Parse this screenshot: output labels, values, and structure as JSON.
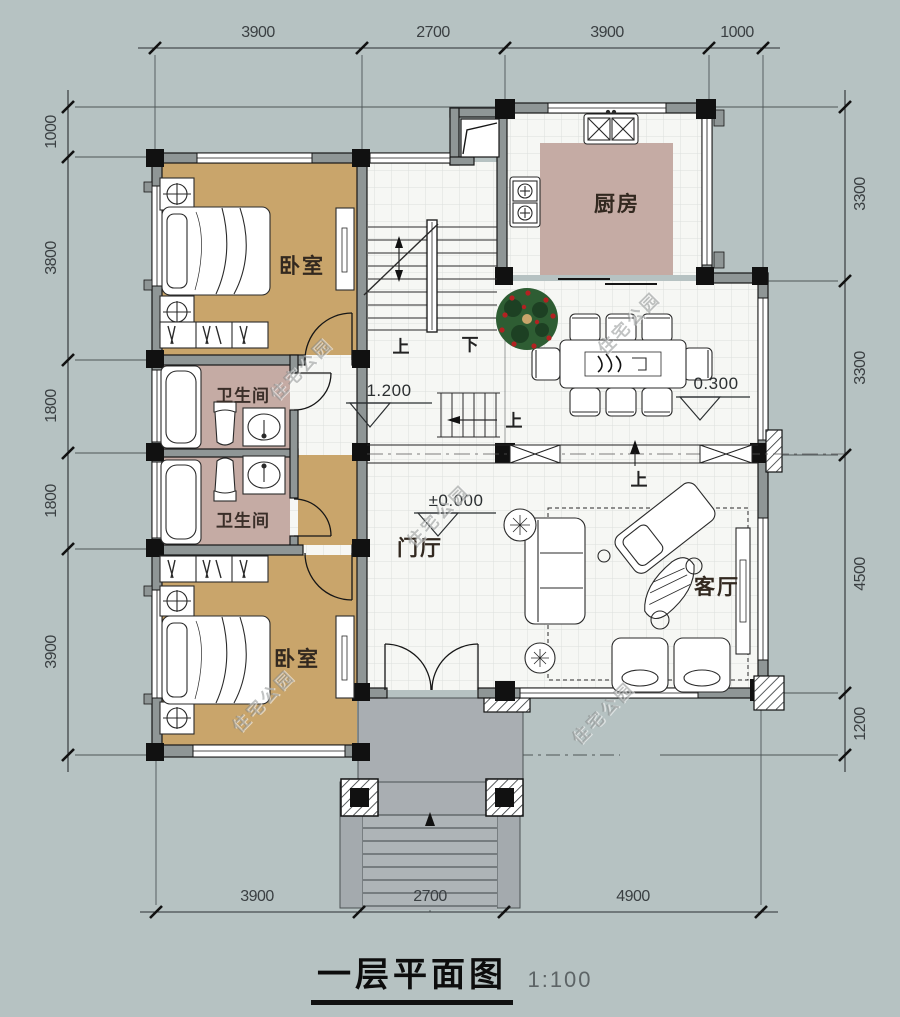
{
  "title": {
    "text": "一层平面图",
    "scale": "1:100"
  },
  "watermark": {
    "text": "住宅公园"
  },
  "dimensions": {
    "top": [
      "3900",
      "2700",
      "3900",
      "1000"
    ],
    "bottom": [
      "3900",
      "2700",
      "4900"
    ],
    "left": [
      "1000",
      "3800",
      "1800",
      "1800",
      "3900"
    ],
    "right": [
      "3300",
      "3300",
      "4500",
      "1200"
    ]
  },
  "rooms": {
    "bedroom_top": "卧室",
    "kitchen": "厨房",
    "bathroom_upper": "卫生间",
    "bathroom_lower": "卫生间",
    "bedroom_bottom": "卧室",
    "foyer": "门厅",
    "living_room": "客厅"
  },
  "elevations": {
    "stair_landing": "1.200",
    "dining": "0.300",
    "entry": "±0.000"
  },
  "stair_labels": {
    "up": "上",
    "down": "下"
  },
  "colors": {
    "background": "#b6c2c2",
    "bedroom_floor": "#c9a56b",
    "bathroom_floor": "#c5aba4",
    "kitchen_counter": "#c5aba4",
    "porch": "#a9aeb2",
    "wall_fill": "#8f9696",
    "line": "#1b1b1b"
  }
}
